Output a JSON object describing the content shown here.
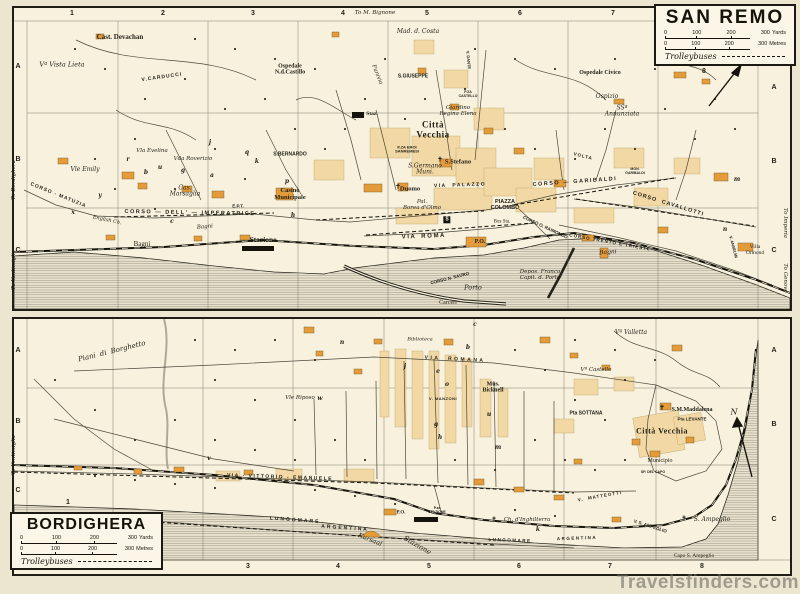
{
  "watermark": {
    "text": "Travelsfinders.com"
  },
  "sanremo_box": {
    "title": "SAN REMO",
    "s0": "0",
    "s1": "100",
    "s2": "200",
    "s3": "300",
    "yards": "Yards",
    "metres": "Metres",
    "trolleybuses": "Trolleybuses"
  },
  "bordighera_box": {
    "title": "BORDIGHERA",
    "s0": "0",
    "s1": "100",
    "s2": "200",
    "s3": "300",
    "yards": "Yards",
    "metres": "Metres",
    "trolleybuses": "Trolleybuses"
  },
  "panels": [
    {
      "id": "sanremo",
      "grid_numbers": [
        {
          "t": "1",
          "x": 58,
          "y": 6
        },
        {
          "t": "2",
          "x": 149,
          "y": 6
        },
        {
          "t": "3",
          "x": 239,
          "y": 6
        },
        {
          "t": "4",
          "x": 329,
          "y": 6
        },
        {
          "t": "5",
          "x": 413,
          "y": 6
        },
        {
          "t": "6",
          "x": 506,
          "y": 6
        },
        {
          "t": "7",
          "x": 599,
          "y": 6
        },
        {
          "t": "8",
          "x": 690,
          "y": 64
        }
      ],
      "grid_letters": [
        {
          "t": "A",
          "x": 4,
          "y": 59
        },
        {
          "t": "B",
          "x": 4,
          "y": 152
        },
        {
          "t": "C",
          "x": 4,
          "y": 243
        },
        {
          "t": "A",
          "x": 760,
          "y": 80
        },
        {
          "t": "B",
          "x": 760,
          "y": 154
        },
        {
          "t": "C",
          "x": 760,
          "y": 243
        }
      ],
      "edge_labels": [
        {
          "t": "To M. Bignone",
          "x": 361,
          "y": 6
        },
        {
          "t": "To Bordighera",
          "x": 1,
          "y": 172,
          "r": -90
        },
        {
          "t": "To Ventimiglia",
          "x": 1,
          "y": 262,
          "r": -90
        },
        {
          "t": "To Imperia",
          "x": 770,
          "y": 215,
          "r": 90
        },
        {
          "t": "To Genova",
          "x": 770,
          "y": 270,
          "r": 90
        }
      ],
      "labels": [
        {
          "t": "Cast. Devachan",
          "x": 106,
          "y": 30,
          "st": "b",
          "fs": 7
        },
        {
          "t": "Vª Vista Lieta",
          "x": 48,
          "y": 57,
          "st": "it",
          "fs": 6.5
        },
        {
          "t": "Ospedale\nN.d.Castillo",
          "x": 276,
          "y": 62,
          "st": "b",
          "fs": 6
        },
        {
          "t": "Mad. d. Costa",
          "x": 404,
          "y": 24,
          "st": "it",
          "fs": 6
        },
        {
          "t": "V.CARDUCCI",
          "x": 148,
          "y": 70,
          "st": "cap",
          "fs": 5,
          "ls": 1,
          "r": -8
        },
        {
          "t": "Funivia",
          "x": 362,
          "y": 67,
          "st": "it",
          "fs": 5.5,
          "r": 68
        },
        {
          "t": "S.GIUSEPPE",
          "x": 399,
          "y": 69,
          "st": "cap",
          "fs": 5
        },
        {
          "t": "Ospedale Civico",
          "x": 586,
          "y": 65,
          "st": "b",
          "fs": 6
        },
        {
          "t": "Ospizio",
          "x": 593,
          "y": 89,
          "st": "it",
          "fs": 6
        },
        {
          "t": "SSª\nAnnunziata",
          "x": 608,
          "y": 104,
          "st": "it",
          "fs": 6
        },
        {
          "t": "Staz.",
          "x": 358,
          "y": 107,
          "st": "b",
          "fs": 5.5
        },
        {
          "t": "Città\nVecchia",
          "x": 419,
          "y": 122,
          "st": "big",
          "fs": 9
        },
        {
          "t": "Giardino\nRegina Elena",
          "x": 444,
          "y": 104,
          "st": "it",
          "fs": 5.5
        },
        {
          "t": "S.BERNARDO",
          "x": 276,
          "y": 147,
          "st": "cap",
          "fs": 5
        },
        {
          "t": "Vla Evelina",
          "x": 138,
          "y": 144,
          "st": "it",
          "fs": 5.5
        },
        {
          "t": "Vda Roverizio",
          "x": 179,
          "y": 152,
          "st": "it",
          "fs": 5.5
        },
        {
          "t": "Vle Emily",
          "x": 71,
          "y": 162,
          "st": "it",
          "fs": 6
        },
        {
          "t": "Cas.\nMarsaglia",
          "x": 171,
          "y": 184,
          "st": "it",
          "fs": 6
        },
        {
          "t": "Casinò\nMunicipale",
          "x": 276,
          "y": 186,
          "st": "b",
          "fs": 6.5
        },
        {
          "t": "E.P.T.",
          "x": 224,
          "y": 199,
          "st": "cap",
          "fs": 4.5
        },
        {
          "t": "CORSO - MATUZIA",
          "x": 44,
          "y": 188,
          "st": "cap",
          "fs": 5,
          "ls": 1,
          "r": 22
        },
        {
          "t": "CORSO — DELL' — IMPERATRICE",
          "x": 176,
          "y": 206,
          "st": "cap",
          "fs": 5.5,
          "ls": 1.5,
          "r": 1
        },
        {
          "t": "English Ch.",
          "x": 93,
          "y": 213,
          "st": "it",
          "fs": 5,
          "r": 12
        },
        {
          "t": "Bagni",
          "x": 128,
          "y": 237,
          "st": "rm",
          "fs": 7
        },
        {
          "t": "Bagni",
          "x": 191,
          "y": 220,
          "st": "it",
          "fs": 5.5,
          "r": -5
        },
        {
          "t": "Stazione",
          "x": 249,
          "y": 232,
          "st": "b",
          "fs": 7.5
        },
        {
          "t": "S.Germano\nMuni.",
          "x": 411,
          "y": 162,
          "st": "it",
          "fs": 6
        },
        {
          "t": "✝",
          "x": 384,
          "y": 179,
          "st": "b",
          "fs": 6.5
        },
        {
          "t": "Duomo",
          "x": 396,
          "y": 181,
          "st": "b",
          "fs": 6.5
        },
        {
          "t": "✝",
          "x": 426,
          "y": 152,
          "st": "b",
          "fs": 6.5
        },
        {
          "t": "S.Stefano",
          "x": 444,
          "y": 154,
          "st": "b",
          "fs": 6.5
        },
        {
          "t": "P.ZA EROI\nSANREMESI",
          "x": 393,
          "y": 142,
          "st": "cap",
          "fs": 4
        },
        {
          "t": "VIA  PALAZZO",
          "x": 446,
          "y": 178,
          "st": "cap",
          "fs": 5,
          "ls": 1.5,
          "r": -2
        },
        {
          "t": "Pal.\nBorea d'Olmo",
          "x": 408,
          "y": 198,
          "st": "it",
          "fs": 5.5
        },
        {
          "t": "PIAZZA\nCOLOMBO",
          "x": 491,
          "y": 198,
          "st": "cap",
          "fs": 5.5
        },
        {
          "t": "Bus Sta.",
          "x": 488,
          "y": 214,
          "st": "rm",
          "fs": 5
        },
        {
          "t": "CORSO — GARIBALDI",
          "x": 561,
          "y": 175,
          "st": "cap",
          "fs": 5.5,
          "ls": 1.5,
          "r": -4
        },
        {
          "t": "VOLTA",
          "x": 569,
          "y": 149,
          "st": "cap",
          "fs": 4.5,
          "ls": 1,
          "r": 14
        },
        {
          "t": "MON.\nGARIBALDI",
          "x": 621,
          "y": 164,
          "st": "cap",
          "fs": 3.5
        },
        {
          "t": "CORSO  CAVALLOTTI",
          "x": 654,
          "y": 197,
          "st": "cap",
          "fs": 5.5,
          "ls": 1,
          "r": 17
        },
        {
          "t": "V I A    R O M A",
          "x": 409,
          "y": 229,
          "st": "cap",
          "fs": 6,
          "r": -2
        },
        {
          "t": "P.O.",
          "x": 466,
          "y": 234,
          "st": "b",
          "fs": 6
        },
        {
          "t": "CORSO O. RAIMONDO",
          "x": 531,
          "y": 220,
          "st": "cap",
          "fs": 4.5,
          "r": 25
        },
        {
          "t": "CORSO N. SAURO",
          "x": 436,
          "y": 271,
          "st": "cap",
          "fs": 4.5,
          "r": -14
        },
        {
          "t": "Porto",
          "x": 459,
          "y": 280,
          "st": "it",
          "fs": 6.5
        },
        {
          "t": "Carceri",
          "x": 434,
          "y": 295,
          "st": "rm",
          "fs": 6
        },
        {
          "t": "Depos. Franco\nCapit. d. Porto",
          "x": 526,
          "y": 268,
          "st": "it",
          "fs": 5.5
        },
        {
          "t": "CORSO TRENTO E TRIESTE",
          "x": 596,
          "y": 235,
          "st": "cap",
          "fs": 4.5,
          "ls": 1,
          "r": 10
        },
        {
          "t": "Bagni",
          "x": 594,
          "y": 245,
          "st": "it",
          "fs": 6,
          "r": -4
        },
        {
          "t": "Villa\nOrmond",
          "x": 741,
          "y": 243,
          "st": "rm",
          "fs": 5.5
        },
        {
          "t": "V. ANSELMI",
          "x": 719,
          "y": 239,
          "st": "cap",
          "fs": 4,
          "r": 75
        },
        {
          "t": "V. DANTE",
          "x": 454,
          "y": 52,
          "st": "cap",
          "fs": 4,
          "r": 85
        },
        {
          "t": "P.ZA\nCASTELLO",
          "x": 454,
          "y": 87,
          "st": "cap",
          "fs": 3.5
        },
        {
          "t": "S",
          "x": 433,
          "y": 212,
          "st": "sq",
          "fs": 5
        },
        {
          "t": "N",
          "x": 716,
          "y": 50,
          "st": "it",
          "fs": 8
        },
        {
          "t": "j",
          "x": 196,
          "y": 135,
          "st": "ltr",
          "fs": 6
        },
        {
          "t": "r",
          "x": 114,
          "y": 152,
          "st": "ltr",
          "fs": 6
        },
        {
          "t": "b",
          "x": 132,
          "y": 165,
          "st": "ltr",
          "fs": 6
        },
        {
          "t": "u",
          "x": 146,
          "y": 160,
          "st": "ltr",
          "fs": 6
        },
        {
          "t": "g",
          "x": 169,
          "y": 163,
          "st": "ltr",
          "fs": 6
        },
        {
          "t": "a",
          "x": 198,
          "y": 168,
          "st": "ltr",
          "fs": 6
        },
        {
          "t": "q",
          "x": 233,
          "y": 145,
          "st": "ltr",
          "fs": 6
        },
        {
          "t": "k",
          "x": 243,
          "y": 154,
          "st": "ltr",
          "fs": 6
        },
        {
          "t": "p",
          "x": 273,
          "y": 174,
          "st": "ltr",
          "fs": 6
        },
        {
          "t": "h",
          "x": 279,
          "y": 208,
          "st": "ltr",
          "fs": 6
        },
        {
          "t": "x",
          "x": 59,
          "y": 205,
          "st": "ltr",
          "fs": 6
        },
        {
          "t": "y",
          "x": 86,
          "y": 188,
          "st": "ltr",
          "fs": 6
        },
        {
          "t": "c",
          "x": 158,
          "y": 214,
          "st": "ltr",
          "fs": 6
        },
        {
          "t": "m",
          "x": 723,
          "y": 172,
          "st": "ltr",
          "fs": 6
        },
        {
          "t": "n",
          "x": 711,
          "y": 222,
          "st": "ltr",
          "fs": 6
        }
      ]
    },
    {
      "id": "bordighera",
      "grid_numbers": [
        {
          "t": "1",
          "x": 54,
          "y": 184
        },
        {
          "t": "2",
          "x": 144,
          "y": 248
        },
        {
          "t": "3",
          "x": 234,
          "y": 248
        },
        {
          "t": "4",
          "x": 324,
          "y": 248
        },
        {
          "t": "5",
          "x": 415,
          "y": 248
        },
        {
          "t": "6",
          "x": 505,
          "y": 248
        },
        {
          "t": "7",
          "x": 596,
          "y": 248
        },
        {
          "t": "8",
          "x": 688,
          "y": 248
        }
      ],
      "grid_letters": [
        {
          "t": "A",
          "x": 4,
          "y": 32
        },
        {
          "t": "B",
          "x": 4,
          "y": 103
        },
        {
          "t": "C",
          "x": 4,
          "y": 172
        },
        {
          "t": "A",
          "x": 760,
          "y": 32
        },
        {
          "t": "B",
          "x": 760,
          "y": 106
        },
        {
          "t": "C",
          "x": 760,
          "y": 201
        }
      ],
      "edge_labels": [
        {
          "t": "To Ventimiglia",
          "x": 1,
          "y": 136,
          "r": -90
        }
      ],
      "labels": [
        {
          "t": "Piani  di  Borghetto",
          "x": 98,
          "y": 33,
          "st": "it",
          "fs": 7,
          "r": -14
        },
        {
          "t": "Biblioteca",
          "x": 406,
          "y": 21,
          "st": "it",
          "fs": 5
        },
        {
          "t": "VIA  ROMANA",
          "x": 441,
          "y": 41,
          "st": "cap",
          "fs": 5,
          "ls": 2.5,
          "r": 3
        },
        {
          "t": "Vle Riposo",
          "x": 286,
          "y": 80,
          "st": "it",
          "fs": 5.5
        },
        {
          "t": "Mus.\nBicknell",
          "x": 479,
          "y": 69,
          "st": "b",
          "fs": 6
        },
        {
          "t": "V. MANZONI",
          "x": 429,
          "y": 80,
          "st": "cap",
          "fs": 4,
          "ls": 0.5
        },
        {
          "t": "Vª Castello",
          "x": 582,
          "y": 52,
          "st": "it",
          "fs": 5.5
        },
        {
          "t": "Vª Valletta",
          "x": 617,
          "y": 14,
          "st": "it",
          "fs": 6
        },
        {
          "t": "Pta SOTTANA",
          "x": 572,
          "y": 95,
          "st": "cap",
          "fs": 5
        },
        {
          "t": "✝",
          "x": 648,
          "y": 89,
          "st": "b",
          "fs": 6.5
        },
        {
          "t": "S.M.Maddalena",
          "x": 678,
          "y": 91,
          "st": "b",
          "fs": 6
        },
        {
          "t": "Pta LEVANTE",
          "x": 678,
          "y": 101,
          "st": "cap",
          "fs": 4.5
        },
        {
          "t": "Città Vecchia",
          "x": 648,
          "y": 113,
          "st": "big",
          "fs": 8
        },
        {
          "t": "Municipio",
          "x": 646,
          "y": 142,
          "st": "rm",
          "fs": 6
        },
        {
          "t": "SP. DEL CAPO",
          "x": 639,
          "y": 154,
          "st": "cap",
          "fs": 3.5
        },
        {
          "t": "VIA - VITTORIO - EMANUELE",
          "x": 266,
          "y": 159,
          "st": "cap",
          "fs": 5,
          "ls": 1.5,
          "r": 2
        },
        {
          "t": "V.  MATTEOTTI",
          "x": 586,
          "y": 178,
          "st": "cap",
          "fs": 4.5,
          "ls": 1,
          "r": -10
        },
        {
          "t": "V. S. AMPEGLIO",
          "x": 636,
          "y": 208,
          "st": "cap",
          "fs": 4.5,
          "r": 18
        },
        {
          "t": "✝",
          "x": 480,
          "y": 201,
          "st": "b",
          "fs": 6
        },
        {
          "t": "Ch. d'Inghilterra",
          "x": 513,
          "y": 202,
          "st": "it",
          "fs": 5.5
        },
        {
          "t": "LUNGOMARE",
          "x": 281,
          "y": 202,
          "st": "cap",
          "fs": 5,
          "ls": 2,
          "r": 4
        },
        {
          "t": "ARGENTINA",
          "x": 331,
          "y": 210,
          "st": "cap",
          "fs": 5,
          "ls": 2,
          "r": 4
        },
        {
          "t": "LUNGOMARE",
          "x": 496,
          "y": 222,
          "st": "cap",
          "fs": 4.5,
          "ls": 1.5,
          "r": 2
        },
        {
          "t": "ARGENTINA",
          "x": 563,
          "y": 220,
          "st": "cap",
          "fs": 4.5,
          "ls": 1.5,
          "r": -2
        },
        {
          "t": "Kursaal",
          "x": 356,
          "y": 221,
          "st": "it",
          "fs": 6.5,
          "r": 22
        },
        {
          "t": "Stazione",
          "x": 403,
          "y": 227,
          "st": "it",
          "fs": 7,
          "r": 30
        },
        {
          "t": "P.za\nSTAZIONE",
          "x": 423,
          "y": 192,
          "st": "cap",
          "fs": 3.5
        },
        {
          "t": "P.O.",
          "x": 387,
          "y": 194,
          "st": "b",
          "fs": 5
        },
        {
          "t": "✝",
          "x": 670,
          "y": 200,
          "st": "b",
          "fs": 6
        },
        {
          "t": "S. Ampeglio",
          "x": 698,
          "y": 201,
          "st": "it",
          "fs": 6
        },
        {
          "t": "Capo S. Ampeglio",
          "x": 680,
          "y": 238,
          "st": "rm",
          "fs": 5.5
        },
        {
          "t": "N",
          "x": 720,
          "y": 94,
          "st": "it",
          "fs": 8
        },
        {
          "t": "n",
          "x": 328,
          "y": 24,
          "st": "ltr",
          "fs": 6
        },
        {
          "t": "c",
          "x": 461,
          "y": 6,
          "st": "ltr",
          "fs": 6
        },
        {
          "t": "b",
          "x": 454,
          "y": 29,
          "st": "ltr",
          "fs": 6
        },
        {
          "t": "j",
          "x": 391,
          "y": 48,
          "st": "ltr",
          "fs": 6
        },
        {
          "t": "e",
          "x": 424,
          "y": 53,
          "st": "ltr",
          "fs": 6
        },
        {
          "t": "o",
          "x": 433,
          "y": 66,
          "st": "ltr",
          "fs": 6
        },
        {
          "t": "u",
          "x": 475,
          "y": 96,
          "st": "ltr",
          "fs": 6
        },
        {
          "t": "g",
          "x": 422,
          "y": 106,
          "st": "ltr",
          "fs": 6
        },
        {
          "t": "h",
          "x": 426,
          "y": 119,
          "st": "ltr",
          "fs": 6
        },
        {
          "t": "m",
          "x": 484,
          "y": 129,
          "st": "ltr",
          "fs": 6
        },
        {
          "t": "w",
          "x": 306,
          "y": 80,
          "st": "ltr",
          "fs": 6
        },
        {
          "t": "v",
          "x": 195,
          "y": 140,
          "st": "ltr",
          "fs": 6
        },
        {
          "t": "k",
          "x": 524,
          "y": 211,
          "st": "ltr",
          "fs": 6
        }
      ]
    }
  ]
}
